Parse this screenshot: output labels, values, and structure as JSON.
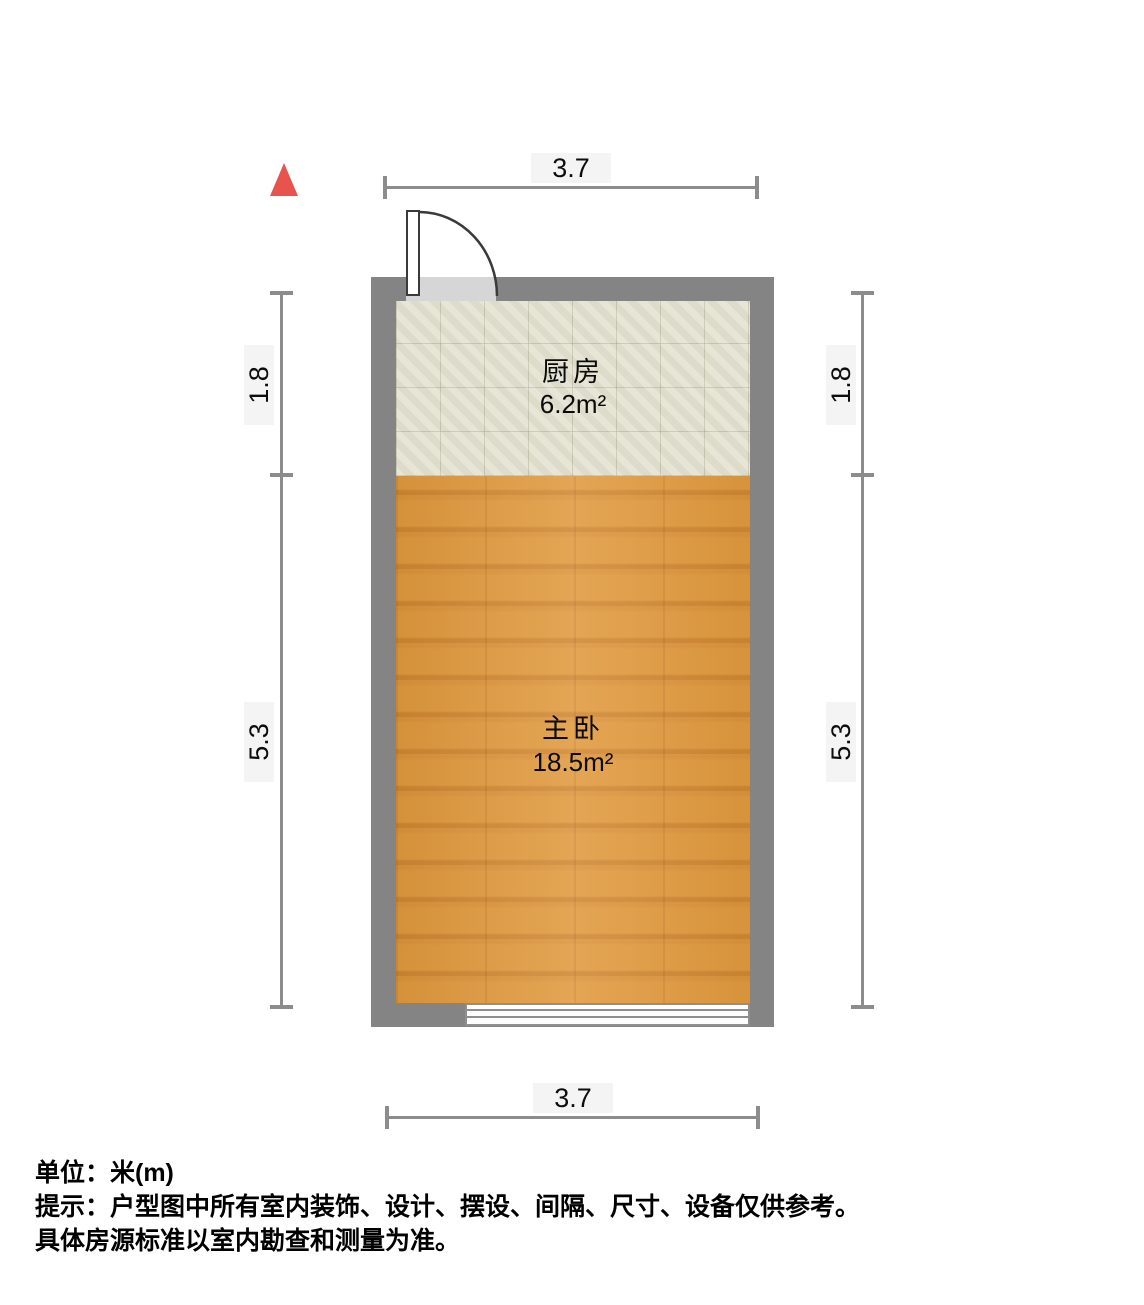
{
  "plan": {
    "north_arrow": {
      "icon": "north-triangle",
      "color": "#e9534e"
    },
    "rooms": [
      {
        "name": "厨房",
        "area": "6.2m²",
        "floor_type": "tile"
      },
      {
        "name": "主卧",
        "area": "18.5m²",
        "floor_type": "wood"
      }
    ],
    "fixtures": {
      "door": "swing-door-top-left",
      "window": "window-bottom-wall"
    },
    "dimensions": {
      "top": "3.7",
      "bottom": "3.7",
      "left": [
        "1.8",
        "5.3"
      ],
      "right": [
        "1.8",
        "5.3"
      ]
    }
  },
  "footer": {
    "unit_line": "单位：米(m)",
    "tip_line1": "提示：户型图中所有室内装饰、设计、摆设、间隔、尺寸、设备仅供参考。",
    "tip_line2": "具体房源标准以室内勘查和测量为准。"
  },
  "colors": {
    "wall": "#848484",
    "kitchen_floor": "#e3e2d1",
    "bedroom_floor": "#e0993d",
    "door_opening": "#d6d6d6",
    "dimension_line": "#8c8c8c",
    "north_arrow": "#e9534e",
    "text": "#000000"
  }
}
